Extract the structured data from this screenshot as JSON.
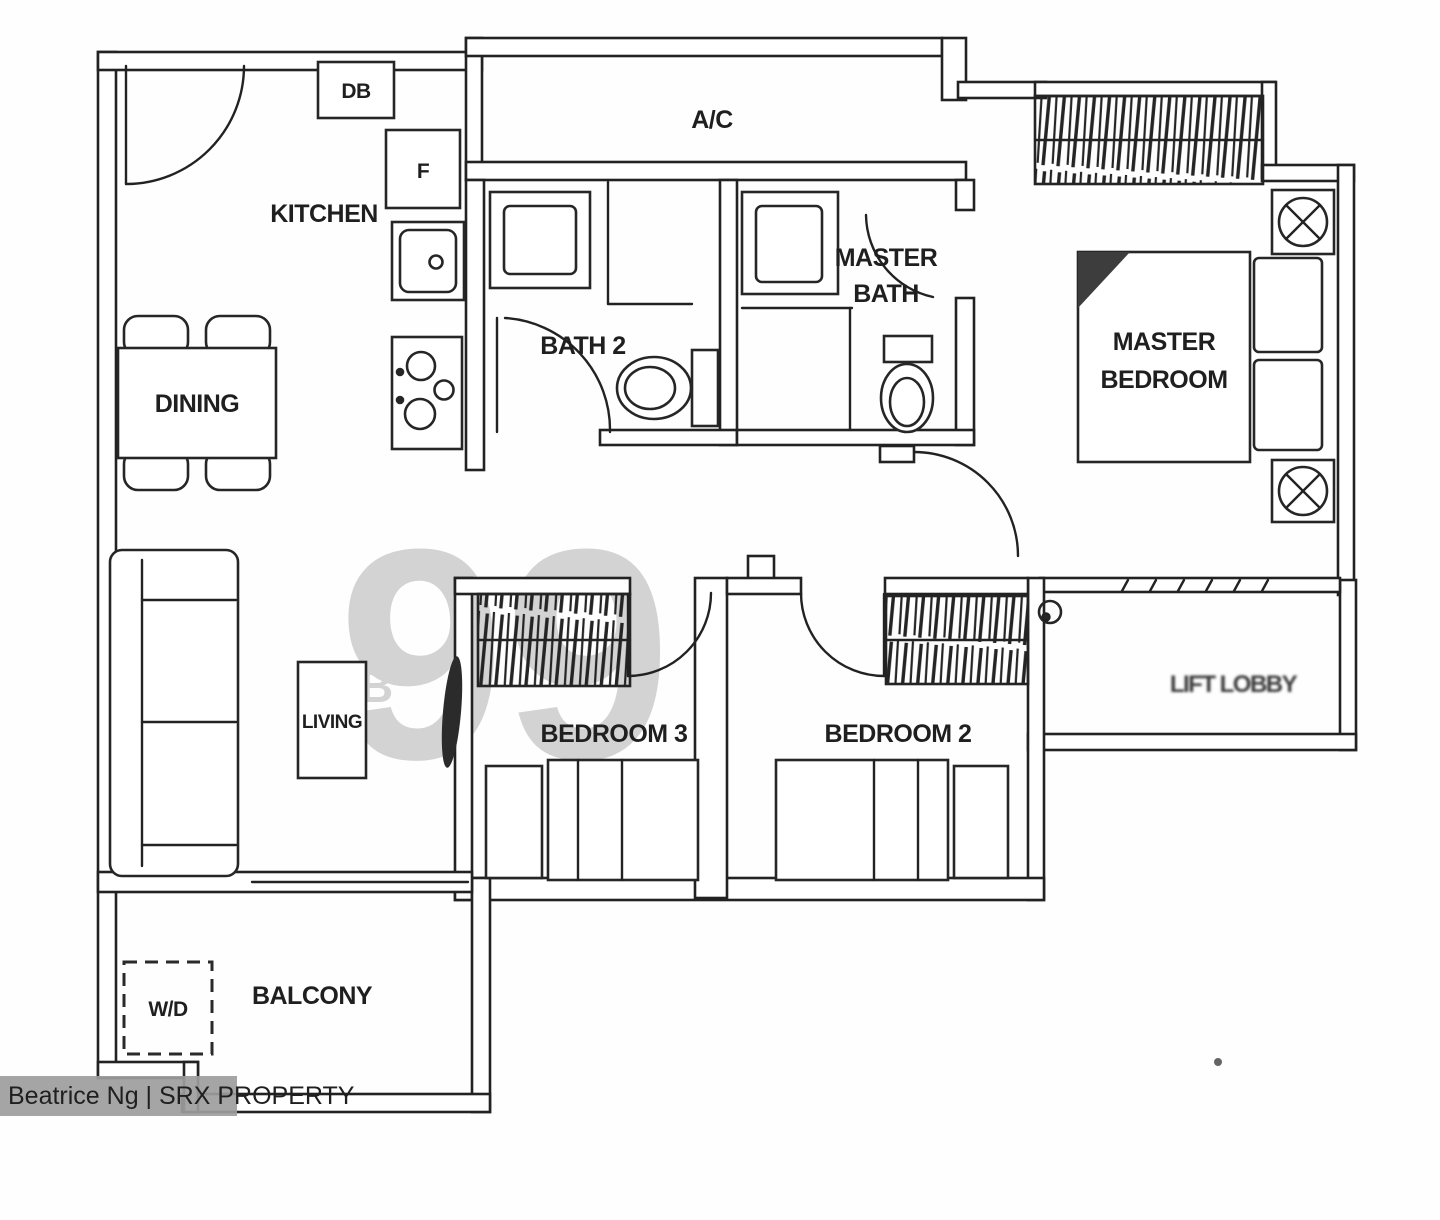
{
  "page": {
    "background": "#fefefe",
    "ink_color": "#222222",
    "watermark_color": "#c8c8c8",
    "agent_bar_color": "#9d9d9d",
    "agent_bar_text_color": "#ffffff"
  },
  "watermarks": {
    "logo_digits": "99",
    "logo_letter": "B",
    "agent_bar_text": "Beatrice Ng | SRX PROPERTY"
  },
  "floorplan": {
    "rooms": {
      "kitchen": {
        "label": "KITCHEN"
      },
      "dining": {
        "label": "DINING"
      },
      "living": {
        "label": "LIVING"
      },
      "balcony": {
        "label": "BALCONY"
      },
      "bath2": {
        "label": "BATH 2"
      },
      "master_bath": {
        "line1": "MASTER",
        "line2": "BATH"
      },
      "master_bedroom": {
        "line1": "MASTER",
        "line2": "BEDROOM"
      },
      "bedroom2": {
        "label": "BEDROOM 2"
      },
      "bedroom3": {
        "label": "BEDROOM 3"
      },
      "lobby": {
        "label": "LIFT LOBBY"
      }
    },
    "fixtures": {
      "db_box": "DB",
      "fridge": "F",
      "ac_ledge": "A/C",
      "washer_dryer": "W/D"
    }
  }
}
